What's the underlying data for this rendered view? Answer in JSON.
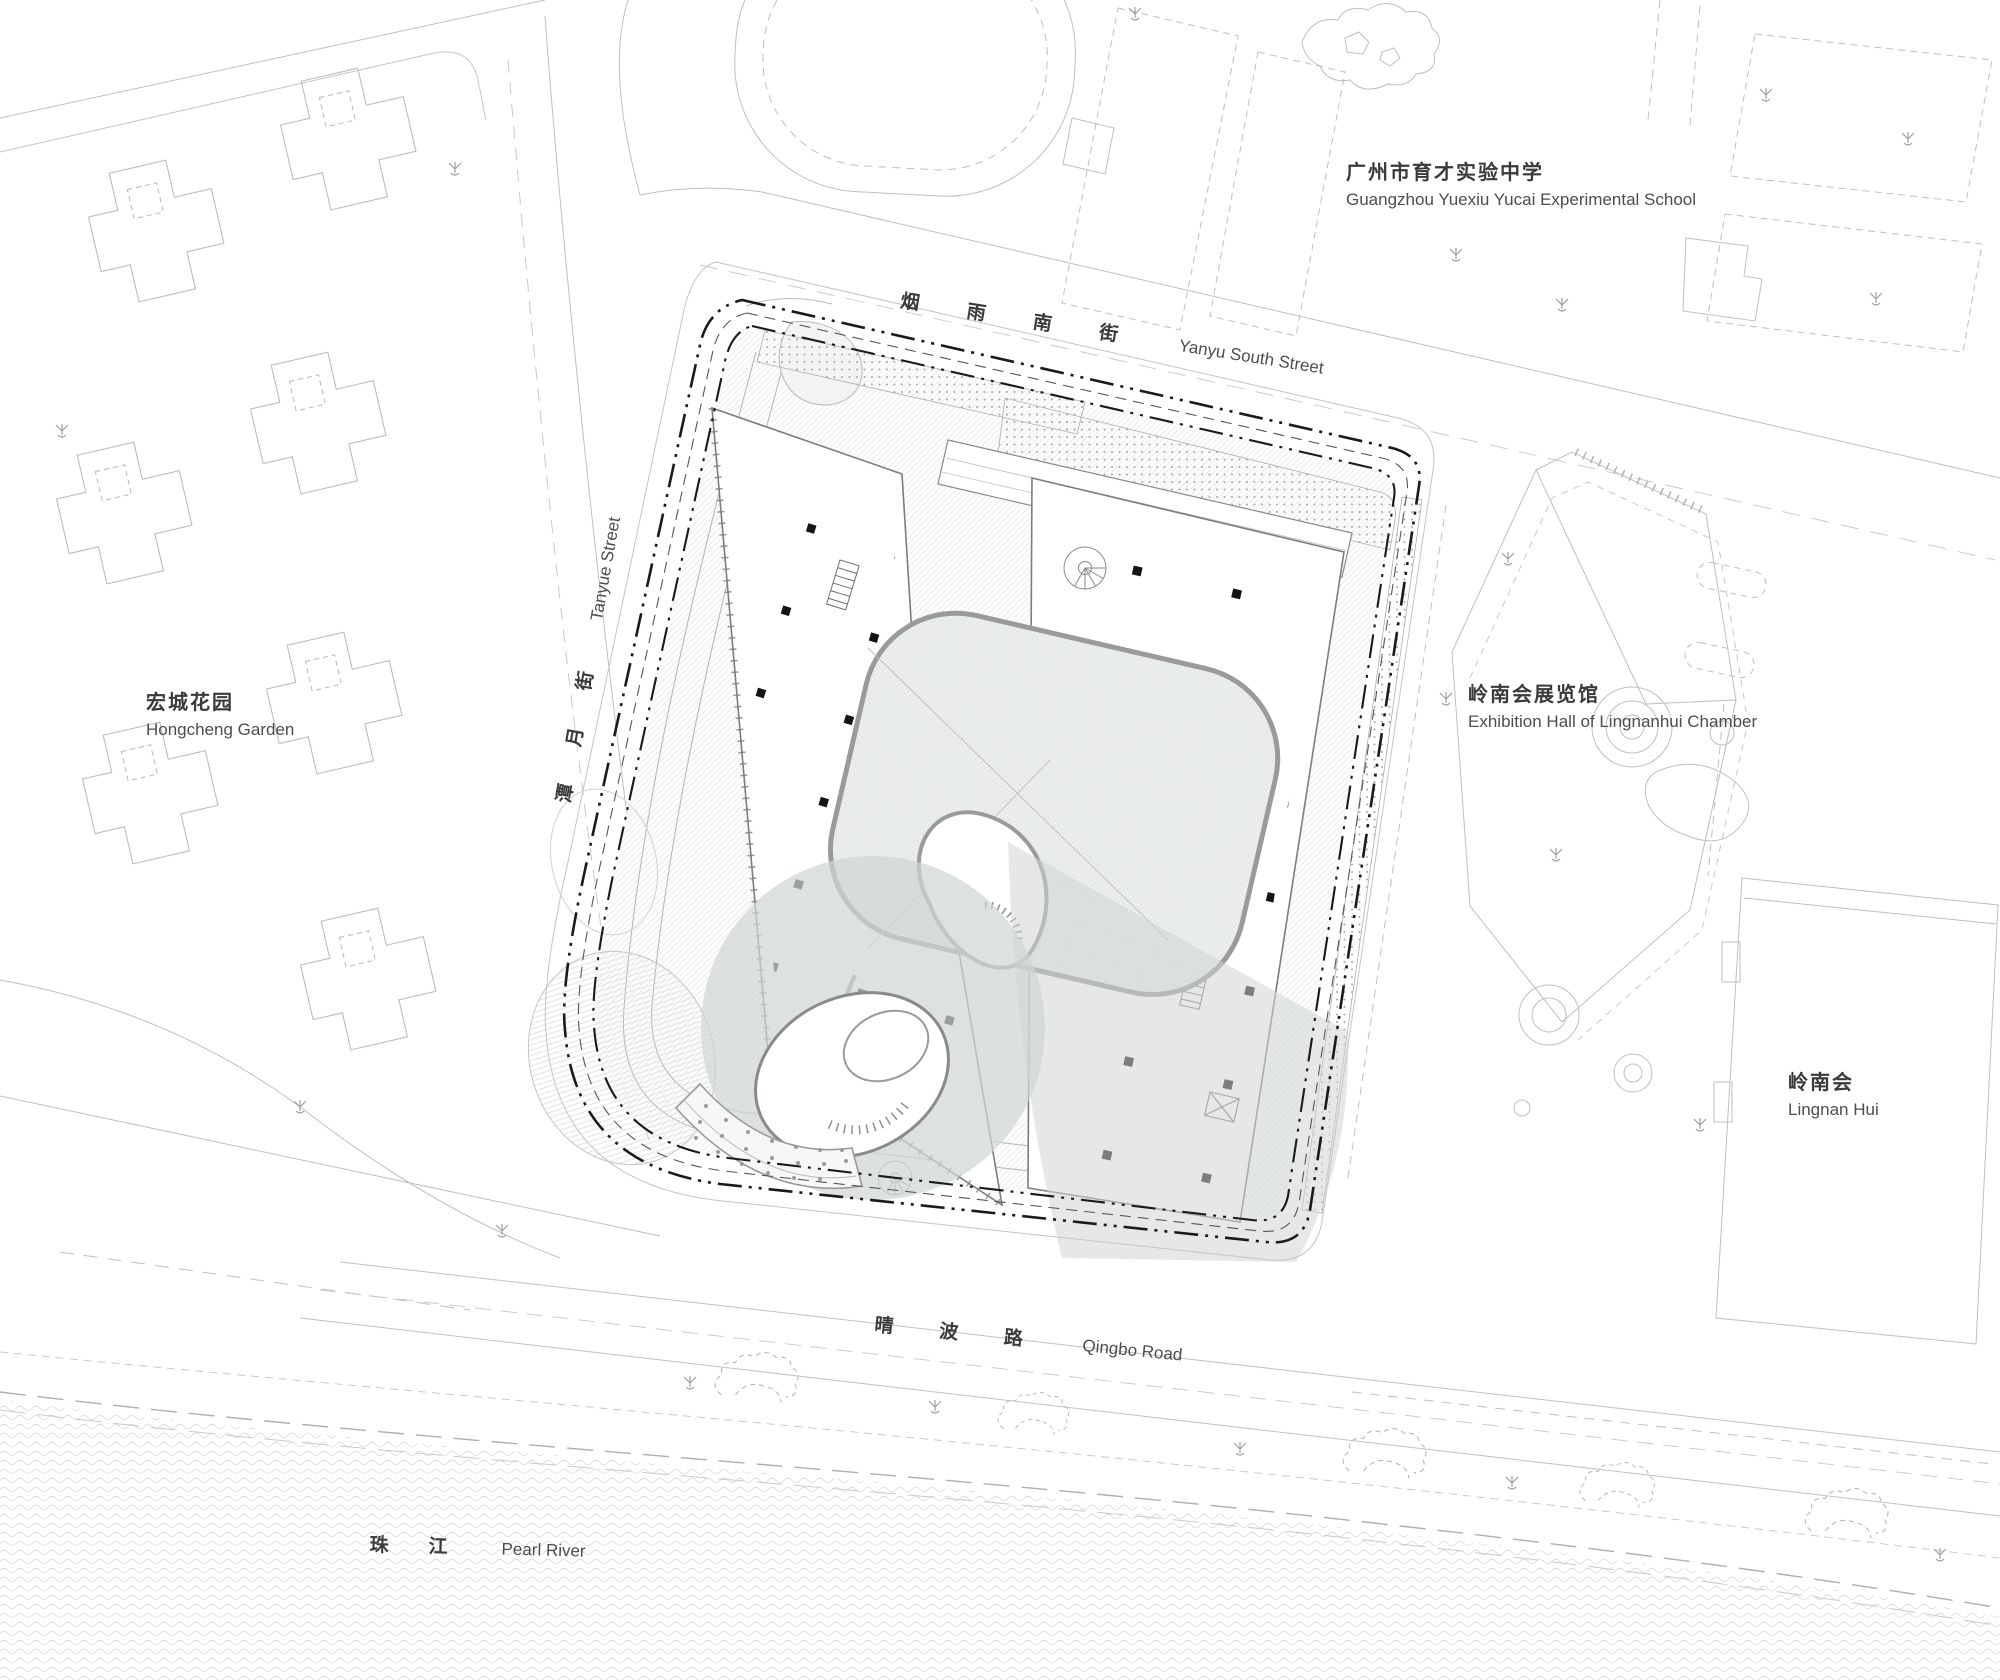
{
  "labels": {
    "school": {
      "cn": "广州市育才实验中学",
      "en": "Guangzhou Yuexiu Yucai Experimental School"
    },
    "yanyu_street": {
      "cn": "烟雨南街",
      "en": "Yanyu South Street"
    },
    "tanyue_street": {
      "cn": "潭月街",
      "en": "Tanyue Street"
    },
    "hongcheng": {
      "cn": "宏城花园",
      "en": "Hongcheng Garden"
    },
    "exhibition_hall": {
      "cn": "岭南会展览馆",
      "en": "Exhibition Hall of Lingnanhui Chamber"
    },
    "lingnan_hui": {
      "cn": "岭南会",
      "en": "Lingnan Hui"
    },
    "qingbo_road": {
      "cn": "晴波路",
      "en": "Qingbo Road"
    },
    "pearl_river": {
      "cn": "珠江",
      "en": "Pearl River"
    }
  },
  "colors": {
    "background": "#ffffff",
    "context_line": "#bdbdbd",
    "site_boundary": "#1a1a1a",
    "building_line": "#7d7d7d",
    "courtyard_line": "#9a9a9a",
    "shade_gray": "#d0d6d4",
    "column_black": "#141414",
    "water_wave": "#dcdcdc",
    "label_text": "#3a3a3a"
  }
}
